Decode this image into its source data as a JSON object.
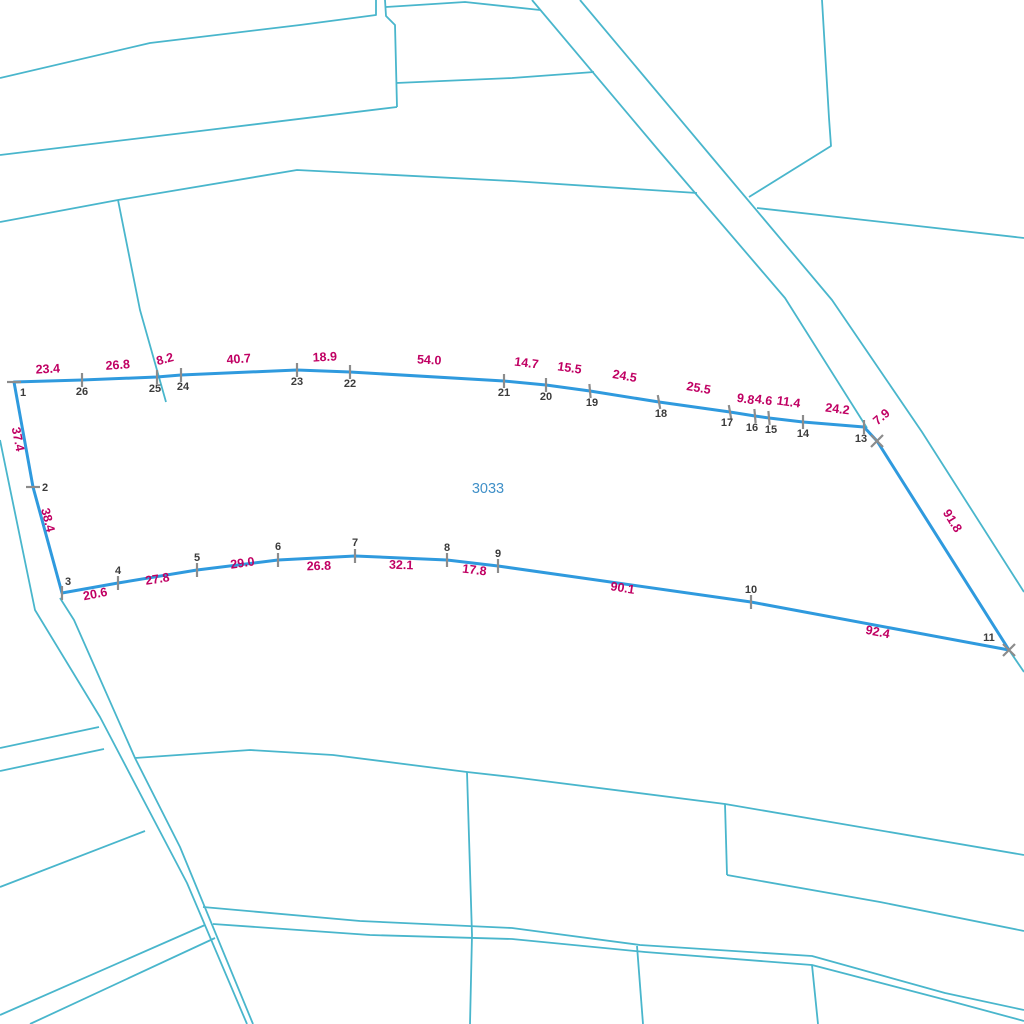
{
  "map": {
    "canvas": {
      "width": 1024,
      "height": 1024,
      "background": "#ffffff"
    },
    "colors": {
      "cadastral_line": "#49b6cc",
      "parcel_line": "#2f9ade",
      "measurement_text": "#c00063",
      "vertex_text": "#3b3b3b",
      "marker": "#8c8c8c",
      "parcel_id_text": "#4090c8"
    },
    "stroke_widths": {
      "cadastral": 1.8,
      "parcel": 3,
      "marker": 2.2
    },
    "parcel": {
      "id_label": "3033",
      "id_label_pos": {
        "x": 488,
        "y": 493
      },
      "boundary_order": [
        "1",
        "26",
        "25",
        "24",
        "23",
        "22",
        "21",
        "20",
        "19",
        "18",
        "17",
        "16",
        "15",
        "14",
        "13",
        "12",
        "11",
        "10",
        "9",
        "8",
        "7",
        "6",
        "5",
        "4",
        "3",
        "2"
      ],
      "vertices": [
        {
          "n": "1",
          "x": 14,
          "y": 382,
          "marker": "tick",
          "mrot": 0,
          "dx": 9,
          "dy": 14,
          "show_label": true
        },
        {
          "n": "2",
          "x": 33,
          "y": 487,
          "marker": "tick",
          "mrot": 0,
          "dx": 12,
          "dy": 4,
          "show_label": true
        },
        {
          "n": "3",
          "x": 62,
          "y": 593,
          "marker": "tick",
          "mrot": 90,
          "dx": 6,
          "dy": -8,
          "show_label": true
        },
        {
          "n": "4",
          "x": 118,
          "y": 583,
          "marker": "tick",
          "mrot": 90,
          "dx": 0,
          "dy": -9,
          "show_label": true
        },
        {
          "n": "5",
          "x": 197,
          "y": 570,
          "marker": "tick",
          "mrot": 90,
          "dx": 0,
          "dy": -9,
          "show_label": true
        },
        {
          "n": "6",
          "x": 278,
          "y": 560,
          "marker": "tick",
          "mrot": 90,
          "dx": 0,
          "dy": -10,
          "show_label": true
        },
        {
          "n": "7",
          "x": 355,
          "y": 556,
          "marker": "tick",
          "mrot": 90,
          "dx": 0,
          "dy": -10,
          "show_label": true
        },
        {
          "n": "8",
          "x": 447,
          "y": 560,
          "marker": "tick",
          "mrot": 90,
          "dx": 0,
          "dy": -9,
          "show_label": true
        },
        {
          "n": "9",
          "x": 498,
          "y": 566,
          "marker": "tick",
          "mrot": 90,
          "dx": 0,
          "dy": -9,
          "show_label": true
        },
        {
          "n": "10",
          "x": 751,
          "y": 602,
          "marker": "tick",
          "mrot": 90,
          "dx": 0,
          "dy": -9,
          "show_label": true
        },
        {
          "n": "11",
          "x": 1009,
          "y": 650,
          "marker": "x",
          "mrot": 0,
          "dx": -20,
          "dy": -9,
          "show_label": true
        },
        {
          "n": "12",
          "x": 877,
          "y": 441,
          "marker": "x",
          "mrot": 0,
          "dx": 0,
          "dy": 0,
          "show_label": false
        },
        {
          "n": "13",
          "x": 864,
          "y": 427,
          "marker": "tick",
          "mrot": 90,
          "dx": -3,
          "dy": 15,
          "show_label": true
        },
        {
          "n": "14",
          "x": 803,
          "y": 422,
          "marker": "tick",
          "mrot": 90,
          "dx": 0,
          "dy": 15,
          "show_label": true
        },
        {
          "n": "15",
          "x": 769,
          "y": 418,
          "marker": "tick",
          "mrot": 85,
          "dx": 2,
          "dy": 15,
          "show_label": true
        },
        {
          "n": "16",
          "x": 755,
          "y": 416,
          "marker": "tick",
          "mrot": 85,
          "dx": -3,
          "dy": 15,
          "show_label": true
        },
        {
          "n": "17",
          "x": 730,
          "y": 412,
          "marker": "tick",
          "mrot": 80,
          "dx": -3,
          "dy": 14,
          "show_label": true
        },
        {
          "n": "18",
          "x": 659,
          "y": 402,
          "marker": "tick",
          "mrot": 80,
          "dx": 2,
          "dy": 15,
          "show_label": true
        },
        {
          "n": "19",
          "x": 590,
          "y": 391,
          "marker": "tick",
          "mrot": 85,
          "dx": 2,
          "dy": 15,
          "show_label": true
        },
        {
          "n": "20",
          "x": 546,
          "y": 385,
          "marker": "tick",
          "mrot": 90,
          "dx": 0,
          "dy": 15,
          "show_label": true
        },
        {
          "n": "21",
          "x": 504,
          "y": 381,
          "marker": "tick",
          "mrot": 90,
          "dx": 0,
          "dy": 15,
          "show_label": true
        },
        {
          "n": "22",
          "x": 350,
          "y": 372,
          "marker": "tick",
          "mrot": 90,
          "dx": 0,
          "dy": 15,
          "show_label": true
        },
        {
          "n": "23",
          "x": 297,
          "y": 370,
          "marker": "tick",
          "mrot": 90,
          "dx": 0,
          "dy": 15,
          "show_label": true
        },
        {
          "n": "24",
          "x": 181,
          "y": 375,
          "marker": "tick",
          "mrot": 90,
          "dx": 2,
          "dy": 15,
          "show_label": true
        },
        {
          "n": "25",
          "x": 157,
          "y": 377,
          "marker": "tick",
          "mrot": 90,
          "dx": -2,
          "dy": 15,
          "show_label": true
        },
        {
          "n": "26",
          "x": 82,
          "y": 380,
          "marker": "tick",
          "mrot": 90,
          "dx": 0,
          "dy": 15,
          "show_label": true
        }
      ],
      "measurements": [
        {
          "t": "23.4",
          "x": 48,
          "y": 373,
          "r": -3
        },
        {
          "t": "26.8",
          "x": 118,
          "y": 369,
          "r": -4
        },
        {
          "t": "8.2",
          "x": 166,
          "y": 363,
          "r": -15
        },
        {
          "t": "40.7",
          "x": 239,
          "y": 363,
          "r": -4
        },
        {
          "t": "18.9",
          "x": 325,
          "y": 361,
          "r": -3
        },
        {
          "t": "54.0",
          "x": 429,
          "y": 364,
          "r": 3
        },
        {
          "t": "14.7",
          "x": 526,
          "y": 367,
          "r": 7
        },
        {
          "t": "15.5",
          "x": 569,
          "y": 372,
          "r": 8
        },
        {
          "t": "24.5",
          "x": 624,
          "y": 380,
          "r": 10
        },
        {
          "t": "25.5",
          "x": 698,
          "y": 392,
          "r": 10
        },
        {
          "t": "9.8",
          "x": 745,
          "y": 403,
          "r": 9
        },
        {
          "t": "4.6",
          "x": 763,
          "y": 404,
          "r": 9
        },
        {
          "t": "11.4",
          "x": 788,
          "y": 406,
          "r": 8
        },
        {
          "t": "24.2",
          "x": 837,
          "y": 413,
          "r": 7
        },
        {
          "t": "7.9",
          "x": 884,
          "y": 420,
          "r": -40
        },
        {
          "t": "91.8",
          "x": 949,
          "y": 523,
          "r": 58
        },
        {
          "t": "92.4",
          "x": 877,
          "y": 636,
          "r": 11
        },
        {
          "t": "90.1",
          "x": 622,
          "y": 592,
          "r": 9
        },
        {
          "t": "17.8",
          "x": 474,
          "y": 574,
          "r": 7
        },
        {
          "t": "32.1",
          "x": 401,
          "y": 569,
          "r": 2
        },
        {
          "t": "26.8",
          "x": 319,
          "y": 570,
          "r": -2
        },
        {
          "t": "29.0",
          "x": 243,
          "y": 567,
          "r": -8
        },
        {
          "t": "27.8",
          "x": 158,
          "y": 583,
          "r": -9
        },
        {
          "t": "20.6",
          "x": 96,
          "y": 598,
          "r": -11
        },
        {
          "t": "38.4",
          "x": 44,
          "y": 521,
          "r": 76
        },
        {
          "t": "37.4",
          "x": 14,
          "y": 440,
          "r": 79
        }
      ]
    },
    "background_lines": [
      [
        [
          0,
          78
        ],
        [
          150,
          43
        ],
        [
          300,
          25
        ],
        [
          376,
          15
        ],
        [
          376,
          0
        ]
      ],
      [
        [
          385,
          0
        ],
        [
          386,
          16
        ],
        [
          395,
          25
        ],
        [
          397,
          107
        ]
      ],
      [
        [
          0,
          155
        ],
        [
          200,
          131
        ],
        [
          397,
          107
        ]
      ],
      [
        [
          396,
          83
        ],
        [
          512,
          78
        ],
        [
          594,
          72
        ]
      ],
      [
        [
          386,
          7
        ],
        [
          465,
          2
        ],
        [
          540,
          10
        ]
      ],
      [
        [
          532,
          0
        ],
        [
          660,
          152
        ],
        [
          785,
          298
        ],
        [
          867,
          428
        ]
      ],
      [
        [
          580,
          0
        ],
        [
          710,
          155
        ],
        [
          832,
          300
        ],
        [
          922,
          432
        ],
        [
          1024,
          592
        ]
      ],
      [
        [
          757,
          208
        ],
        [
          900,
          224
        ],
        [
          1024,
          238
        ]
      ],
      [
        [
          822,
          0
        ],
        [
          829,
          118
        ],
        [
          831,
          146
        ],
        [
          749,
          197
        ]
      ],
      [
        [
          0,
          222
        ],
        [
          118,
          200
        ],
        [
          297,
          170
        ],
        [
          512,
          181
        ],
        [
          697,
          193
        ]
      ],
      [
        [
          118,
          200
        ],
        [
          140,
          310
        ],
        [
          166,
          402
        ]
      ],
      [
        [
          0,
          440
        ],
        [
          35,
          610
        ],
        [
          100,
          717
        ],
        [
          187,
          883
        ],
        [
          247,
          1024
        ]
      ],
      [
        [
          60,
          598
        ],
        [
          74,
          620
        ],
        [
          135,
          758
        ],
        [
          180,
          847
        ],
        [
          253,
          1024
        ]
      ],
      [
        [
          0,
          748
        ],
        [
          99,
          727
        ]
      ],
      [
        [
          0,
          771
        ],
        [
          104,
          749
        ]
      ],
      [
        [
          0,
          887
        ],
        [
          145,
          831
        ]
      ],
      [
        [
          135,
          758
        ],
        [
          250,
          750
        ],
        [
          333,
          755
        ],
        [
          467,
          772
        ],
        [
          512,
          777
        ],
        [
          725,
          804
        ],
        [
          1024,
          855
        ]
      ],
      [
        [
          725,
          804
        ],
        [
          727,
          875
        ]
      ],
      [
        [
          727,
          875
        ],
        [
          880,
          902
        ],
        [
          1024,
          931
        ]
      ],
      [
        [
          203,
          907
        ],
        [
          360,
          921
        ],
        [
          512,
          928
        ],
        [
          640,
          945
        ],
        [
          812,
          956
        ],
        [
          945,
          993
        ],
        [
          1024,
          1010
        ]
      ],
      [
        [
          213,
          924
        ],
        [
          370,
          935
        ],
        [
          512,
          939
        ],
        [
          645,
          952
        ],
        [
          812,
          965
        ],
        [
          950,
          1001
        ],
        [
          1024,
          1021
        ]
      ],
      [
        [
          467,
          772
        ],
        [
          472,
          935
        ],
        [
          470,
          1024
        ]
      ],
      [
        [
          637,
          946
        ],
        [
          643,
          1024
        ]
      ],
      [
        [
          812,
          965
        ],
        [
          818,
          1024
        ]
      ],
      [
        [
          0,
          1015
        ],
        [
          205,
          925
        ]
      ],
      [
        [
          30,
          1024
        ],
        [
          215,
          938
        ]
      ],
      [
        [
          1009,
          650
        ],
        [
          1024,
          672
        ]
      ]
    ]
  }
}
